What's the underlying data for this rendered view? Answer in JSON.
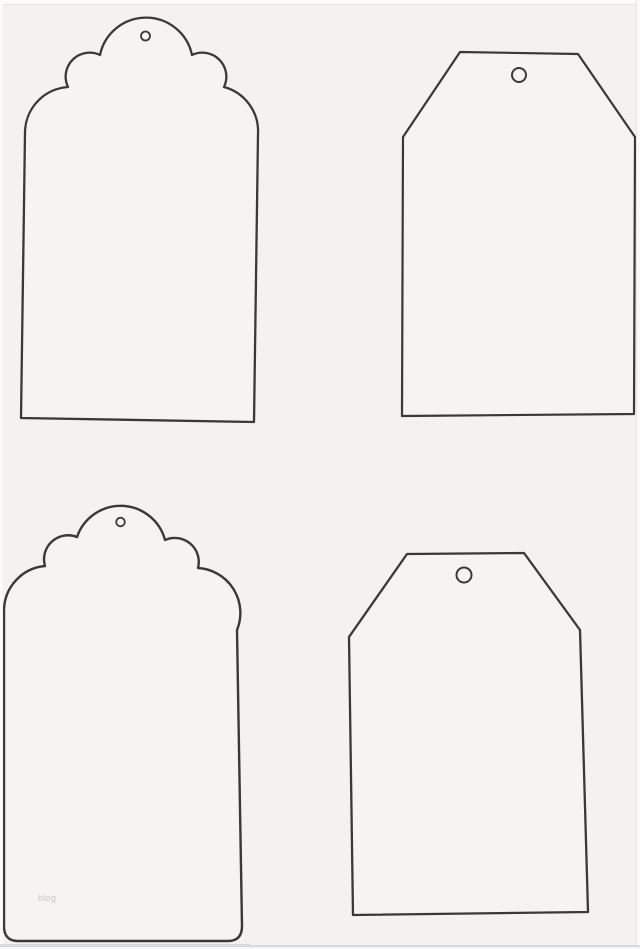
{
  "page": {
    "description": "Printable blank gift tag template sheet, scanned",
    "background_color": "#f3f2ef",
    "tag_fill_color": "#f5f4f1",
    "outline_color": "#3b3936",
    "edge_color": "#fbfbf9",
    "watermark_text": "blog",
    "watermark_color": "#c9c7c3"
  },
  "tags": [
    {
      "name": "scalloped-tag-top-left",
      "shape": "scalloped-top",
      "outline_path": "M 25,133 A 46,46 0 0 1 68,87 A 24,24 0 0 1 100,55 A 47,47 0 0 1 192,55 A 24,24 0 0 1 224,87 A 46,46 0 0 1 258,134 L 254,422 L 21,418 Z",
      "hole": {
        "cx": 145.5,
        "cy": 36,
        "r": 4.5
      },
      "stroke_width": 2.3,
      "hole_stroke_width": 1.8
    },
    {
      "name": "angled-tag-top-right",
      "shape": "angled-corners",
      "outline_path": "M 460,52 L 578,54 L 635,137 L 634,414 L 402,416 L 403,137 Z",
      "hole": {
        "cx": 519,
        "cy": 75,
        "r": 7
      },
      "stroke_width": 2.2,
      "hole_stroke_width": 2
    },
    {
      "name": "scalloped-tag-bottom-left",
      "shape": "scalloped-top",
      "outline_path": "M 4,610 A 45,45 0 0 1 45,566 A 24,24 0 0 1 77,537 A 46,46 0 0 1 165,540 A 24,24 0 0 1 198,568 A 45,45 0 0 1 237,630 L 242,926 Q 242,941 228,941 L 18,941 Q 4,941 4,926 Z",
      "hole": {
        "cx": 120.5,
        "cy": 522,
        "r": 4.3
      },
      "stroke_width": 2.4,
      "hole_stroke_width": 1.8
    },
    {
      "name": "angled-tag-bottom-right",
      "shape": "angled-corners",
      "outline_path": "M 407,554 L 524,553 L 580,630 L 588,912 L 353,915 L 349,637 Z",
      "hole": {
        "cx": 464,
        "cy": 575,
        "r": 7.5
      },
      "stroke_width": 2.3,
      "hole_stroke_width": 2
    }
  ]
}
